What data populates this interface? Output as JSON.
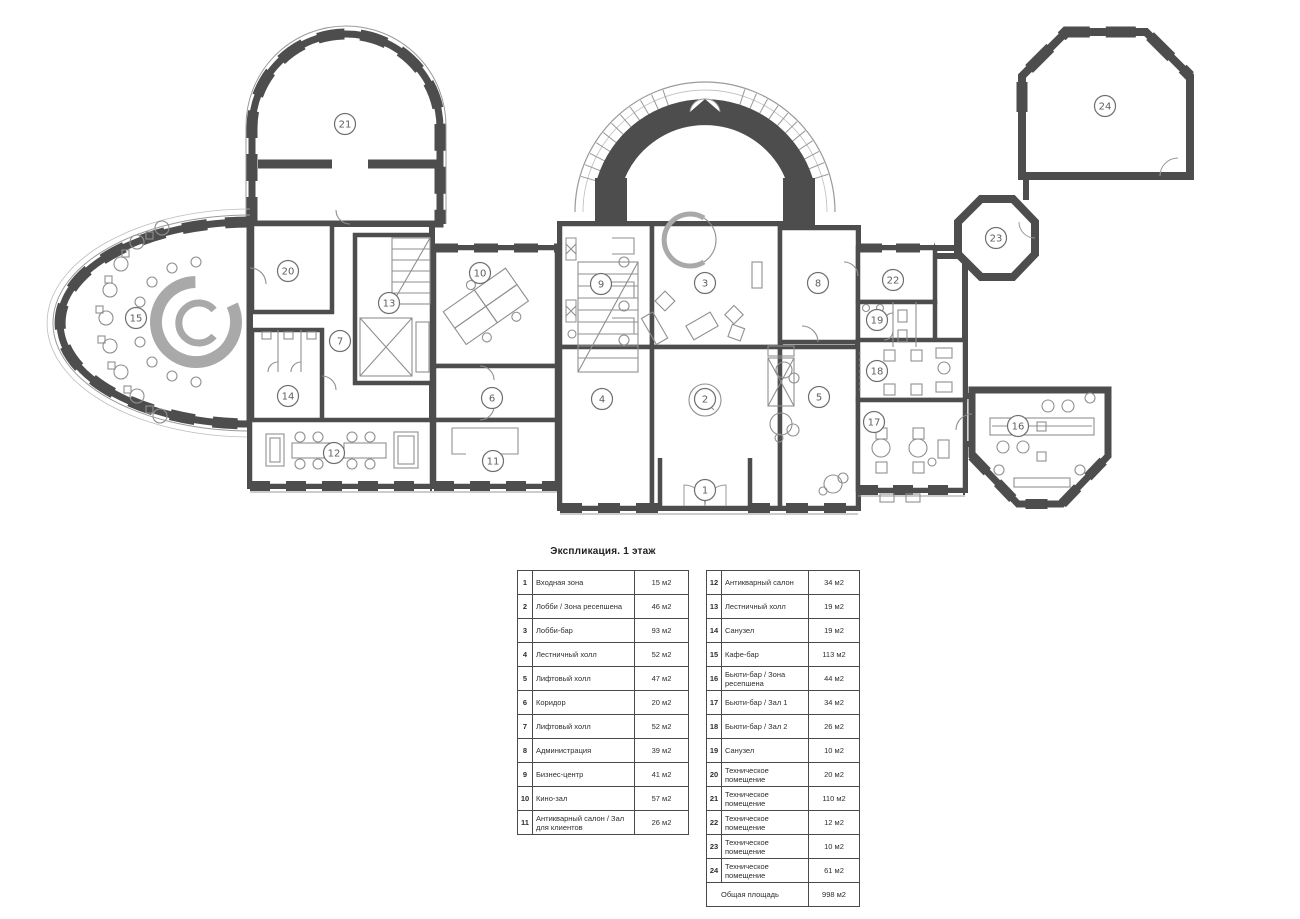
{
  "plan": {
    "colors": {
      "wall": "#4d4d4d",
      "line": "#9a9a9a",
      "furniture": "#8f8f8f",
      "marker": "#6e6e6e"
    },
    "rooms": [
      {
        "num": "1",
        "x": 705,
        "y": 490
      },
      {
        "num": "2",
        "x": 705,
        "y": 399
      },
      {
        "num": "3",
        "x": 705,
        "y": 283
      },
      {
        "num": "4",
        "x": 602,
        "y": 399
      },
      {
        "num": "5",
        "x": 819,
        "y": 397
      },
      {
        "num": "6",
        "x": 492,
        "y": 398
      },
      {
        "num": "7",
        "x": 340,
        "y": 341
      },
      {
        "num": "8",
        "x": 818,
        "y": 283
      },
      {
        "num": "9",
        "x": 601,
        "y": 284
      },
      {
        "num": "10",
        "x": 480,
        "y": 273
      },
      {
        "num": "11",
        "x": 493,
        "y": 461
      },
      {
        "num": "12",
        "x": 334,
        "y": 453
      },
      {
        "num": "13",
        "x": 389,
        "y": 303
      },
      {
        "num": "14",
        "x": 288,
        "y": 396
      },
      {
        "num": "15",
        "x": 136,
        "y": 318
      },
      {
        "num": "16",
        "x": 1018,
        "y": 426
      },
      {
        "num": "17",
        "x": 874,
        "y": 422
      },
      {
        "num": "18",
        "x": 877,
        "y": 371
      },
      {
        "num": "19",
        "x": 877,
        "y": 320
      },
      {
        "num": "20",
        "x": 288,
        "y": 271
      },
      {
        "num": "21",
        "x": 345,
        "y": 124
      },
      {
        "num": "22",
        "x": 893,
        "y": 280
      },
      {
        "num": "23",
        "x": 996,
        "y": 238
      },
      {
        "num": "24",
        "x": 1105,
        "y": 106
      }
    ]
  },
  "legend": {
    "title": "Экспликация. 1 этаж",
    "left_rows": [
      {
        "num": "1",
        "name": "Входная зона",
        "area": "15 м2"
      },
      {
        "num": "2",
        "name": "Лобби / Зона ресепшена",
        "area": "46 м2"
      },
      {
        "num": "3",
        "name": "Лобби-бар",
        "area": "93 м2"
      },
      {
        "num": "4",
        "name": "Лестничный холл",
        "area": "52 м2"
      },
      {
        "num": "5",
        "name": "Лифтовый холл",
        "area": "47 м2"
      },
      {
        "num": "6",
        "name": "Коридор",
        "area": "20 м2"
      },
      {
        "num": "7",
        "name": "Лифтовый холл",
        "area": "52 м2"
      },
      {
        "num": "8",
        "name": "Администрация",
        "area": "39 м2"
      },
      {
        "num": "9",
        "name": "Бизнес-центр",
        "area": "41 м2"
      },
      {
        "num": "10",
        "name": "Кино-зал",
        "area": "57 м2"
      },
      {
        "num": "11",
        "name": "Антикварный салон / Зал для клиентов",
        "area": "26 м2"
      }
    ],
    "right_rows": [
      {
        "num": "12",
        "name": "Антикварный салон",
        "area": "34 м2"
      },
      {
        "num": "13",
        "name": "Лестничный холл",
        "area": "19 м2"
      },
      {
        "num": "14",
        "name": "Санузел",
        "area": "19 м2"
      },
      {
        "num": "15",
        "name": "Кафе-бар",
        "area": "113 м2"
      },
      {
        "num": "16",
        "name": "Бьюти-бар / Зона ресепшена",
        "area": "44 м2"
      },
      {
        "num": "17",
        "name": "Бьюти-бар / Зал 1",
        "area": "34 м2"
      },
      {
        "num": "18",
        "name": "Бьюти-бар / Зал 2",
        "area": "26 м2"
      },
      {
        "num": "19",
        "name": "Санузел",
        "area": "10 м2"
      },
      {
        "num": "20",
        "name": "Техническое помещение",
        "area": "20 м2"
      },
      {
        "num": "21",
        "name": "Техническое помещение",
        "area": "110 м2"
      },
      {
        "num": "22",
        "name": "Техническое помещение",
        "area": "12 м2"
      },
      {
        "num": "23",
        "name": "Техническое помещение",
        "area": "10 м2"
      },
      {
        "num": "24",
        "name": "Техническое помещение",
        "area": "61 м2"
      }
    ],
    "total_row": {
      "name": "Общая площадь",
      "area": "998 м2"
    }
  }
}
